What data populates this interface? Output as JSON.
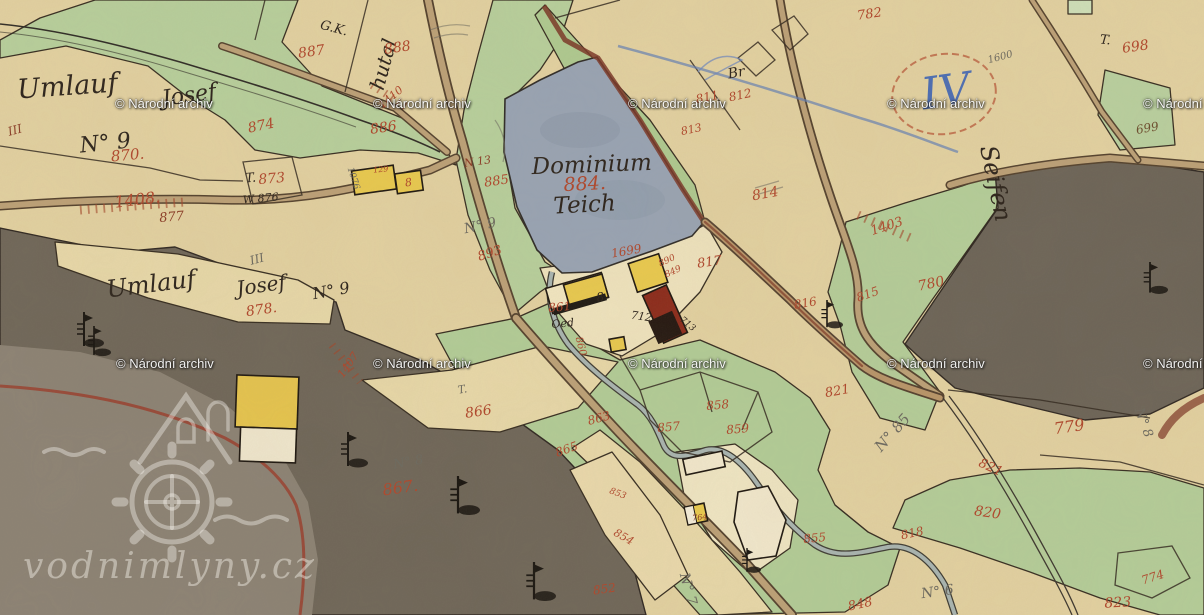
{
  "watermark": {
    "label": "© Národní archiv",
    "rows": [
      {
        "top": 96,
        "xs": [
          115,
          373,
          628,
          887,
          1143
        ]
      },
      {
        "top": 356,
        "xs": [
          116,
          373,
          628,
          887,
          1143
        ]
      }
    ]
  },
  "logo": {
    "text": "vodnimlyny.cz"
  },
  "colors": {
    "ink": "#2b221a",
    "red": "#b0452a",
    "darkred": "#8a3a24",
    "gray": "#6b685e",
    "blue": "#4a6cb3",
    "brown": "#6a4a2a"
  },
  "map": {
    "labels": [
      {
        "t": "Umlauf",
        "x": 68,
        "y": 95,
        "s": 27,
        "c": "ink",
        "r": -4
      },
      {
        "t": "Josef",
        "x": 190,
        "y": 102,
        "s": 22,
        "c": "ink",
        "r": -8
      },
      {
        "t": "N° 9",
        "x": 106,
        "y": 150,
        "s": 22,
        "c": "ink",
        "r": -6
      },
      {
        "t": "Umlauf",
        "x": 152,
        "y": 292,
        "s": 24,
        "c": "ink",
        "r": -7
      },
      {
        "t": "Josef",
        "x": 262,
        "y": 292,
        "s": 20,
        "c": "ink",
        "r": -8
      },
      {
        "t": "N° 9",
        "x": 332,
        "y": 296,
        "s": 16,
        "c": "ink",
        "r": -10
      },
      {
        "t": "Dominium",
        "x": 592,
        "y": 172,
        "s": 23,
        "c": "ink",
        "r": -2
      },
      {
        "t": "Teich",
        "x": 585,
        "y": 212,
        "s": 23,
        "c": "ink",
        "r": -3
      },
      {
        "t": "884.",
        "x": 585,
        "y": 190,
        "s": 19,
        "c": "red",
        "r": -3
      },
      {
        "t": "Oed",
        "x": 563,
        "y": 327,
        "s": 11,
        "c": "ink",
        "r": -5
      },
      {
        "t": "712",
        "x": 641,
        "y": 320,
        "s": 11,
        "c": "ink",
        "r": 8
      },
      {
        "t": "713",
        "x": 686,
        "y": 326,
        "s": 9,
        "c": "ink",
        "r": 40
      },
      {
        "t": "8",
        "x": 601,
        "y": 301,
        "s": 12,
        "c": "ink",
        "r": -10
      },
      {
        "t": "Seifen",
        "x": 988,
        "y": 185,
        "s": 24,
        "c": "ink",
        "r": 78
      },
      {
        "t": "G.K.",
        "x": 333,
        "y": 32,
        "s": 13,
        "c": "ink",
        "r": 15
      },
      {
        "t": "Br",
        "x": 737,
        "y": 77,
        "s": 14,
        "c": "ink",
        "r": -10
      },
      {
        "t": "T.",
        "x": 251,
        "y": 182,
        "s": 13,
        "c": "ink",
        "r": -5
      },
      {
        "t": "T.",
        "x": 1105,
        "y": 44,
        "s": 13,
        "c": "ink",
        "r": 5
      },
      {
        "t": "T.",
        "x": 463,
        "y": 393,
        "s": 11,
        "c": "gray",
        "r": -10
      },
      {
        "t": "W 876",
        "x": 261,
        "y": 202,
        "s": 11,
        "c": "ink",
        "r": -5
      },
      {
        "t": "hutal",
        "x": 390,
        "y": 66,
        "s": 20,
        "c": "ink",
        "r": -75
      },
      {
        "t": "N° 9",
        "x": 481,
        "y": 230,
        "s": 14,
        "c": "gray",
        "r": -12
      },
      {
        "t": "N° 85",
        "x": 896,
        "y": 436,
        "s": 15,
        "c": "gray",
        "r": -48
      },
      {
        "t": "N° 6",
        "x": 938,
        "y": 596,
        "s": 14,
        "c": "gray",
        "r": -8
      },
      {
        "t": "N° 7",
        "x": 684,
        "y": 590,
        "s": 14,
        "c": "gray",
        "r": 75
      },
      {
        "t": "N° 8",
        "x": 409,
        "y": 466,
        "s": 13,
        "c": "gray",
        "r": -10
      },
      {
        "t": "N° 8",
        "x": 1140,
        "y": 424,
        "s": 13,
        "c": "gray",
        "r": 70
      },
      {
        "t": "III",
        "x": 258,
        "y": 263,
        "s": 12,
        "c": "gray",
        "r": -15
      },
      {
        "t": "III",
        "x": 16,
        "y": 134,
        "s": 12,
        "c": "darkred",
        "r": -15
      },
      {
        "t": "1076",
        "x": 351,
        "y": 179,
        "s": 9,
        "c": "gray",
        "r": 72
      },
      {
        "t": "1600",
        "x": 1001,
        "y": 60,
        "s": 10,
        "c": "gray",
        "r": -15
      },
      {
        "t": "IV",
        "x": 948,
        "y": 106,
        "s": 44,
        "c": "blue",
        "r": -8
      },
      {
        "t": "870.",
        "x": 128,
        "y": 160,
        "s": 15,
        "c": "red",
        "r": -5
      },
      {
        "t": "874",
        "x": 262,
        "y": 130,
        "s": 14,
        "c": "red",
        "r": -12
      },
      {
        "t": "877",
        "x": 172,
        "y": 221,
        "s": 13,
        "c": "darkred",
        "r": -5
      },
      {
        "t": "1408.",
        "x": 138,
        "y": 205,
        "s": 16,
        "c": "red",
        "r": -7
      },
      {
        "t": "873",
        "x": 272,
        "y": 183,
        "s": 14,
        "c": "red",
        "r": -5
      },
      {
        "t": "878.",
        "x": 262,
        "y": 314,
        "s": 14,
        "c": "red",
        "r": -8
      },
      {
        "t": "887",
        "x": 312,
        "y": 56,
        "s": 14,
        "c": "red",
        "r": -8
      },
      {
        "t": "888",
        "x": 398,
        "y": 52,
        "s": 14,
        "c": "red",
        "r": -8
      },
      {
        "t": "886",
        "x": 384,
        "y": 132,
        "s": 14,
        "c": "red",
        "r": -8
      },
      {
        "t": "885",
        "x": 497,
        "y": 185,
        "s": 13,
        "c": "red",
        "r": -8
      },
      {
        "t": "N 13",
        "x": 478,
        "y": 165,
        "s": 11,
        "c": "darkred",
        "r": -8
      },
      {
        "t": "893",
        "x": 491,
        "y": 257,
        "s": 13,
        "c": "red",
        "r": -18
      },
      {
        "t": "129",
        "x": 381,
        "y": 172,
        "s": 8,
        "c": "red",
        "r": -5
      },
      {
        "t": "782",
        "x": 870,
        "y": 18,
        "s": 13,
        "c": "red",
        "r": -8
      },
      {
        "t": "811",
        "x": 708,
        "y": 101,
        "s": 12,
        "c": "red",
        "r": -12
      },
      {
        "t": "812",
        "x": 741,
        "y": 99,
        "s": 12,
        "c": "red",
        "r": -12
      },
      {
        "t": "813",
        "x": 692,
        "y": 133,
        "s": 11,
        "c": "red",
        "r": -12
      },
      {
        "t": "814",
        "x": 766,
        "y": 198,
        "s": 14,
        "c": "red",
        "r": -10
      },
      {
        "t": "817",
        "x": 710,
        "y": 266,
        "s": 13,
        "c": "red",
        "r": -8
      },
      {
        "t": "816",
        "x": 806,
        "y": 307,
        "s": 12,
        "c": "red",
        "r": -10
      },
      {
        "t": "815",
        "x": 869,
        "y": 298,
        "s": 12,
        "c": "red",
        "r": -20
      },
      {
        "t": "780",
        "x": 932,
        "y": 288,
        "s": 14,
        "c": "red",
        "r": -12
      },
      {
        "t": "1403",
        "x": 888,
        "y": 230,
        "s": 13,
        "c": "red",
        "r": -18
      },
      {
        "t": "698",
        "x": 1136,
        "y": 51,
        "s": 14,
        "c": "red",
        "r": -8
      },
      {
        "t": "699",
        "x": 1148,
        "y": 132,
        "s": 12,
        "c": "brown",
        "r": -10
      },
      {
        "t": "779",
        "x": 1070,
        "y": 432,
        "s": 16,
        "c": "red",
        "r": -8
      },
      {
        "t": "821",
        "x": 838,
        "y": 395,
        "s": 13,
        "c": "red",
        "r": -10
      },
      {
        "t": "821",
        "x": 989,
        "y": 471,
        "s": 13,
        "c": "red",
        "r": 25
      },
      {
        "t": "820",
        "x": 987,
        "y": 517,
        "s": 14,
        "c": "red",
        "r": 8
      },
      {
        "t": "818",
        "x": 913,
        "y": 537,
        "s": 12,
        "c": "red",
        "r": -12
      },
      {
        "t": "848",
        "x": 861,
        "y": 608,
        "s": 13,
        "c": "red",
        "r": -12
      },
      {
        "t": "823",
        "x": 1118,
        "y": 607,
        "s": 14,
        "c": "red",
        "r": -3
      },
      {
        "t": "774",
        "x": 1154,
        "y": 581,
        "s": 12,
        "c": "red",
        "r": -18
      },
      {
        "t": "866",
        "x": 479,
        "y": 416,
        "s": 14,
        "c": "red",
        "r": -8
      },
      {
        "t": "867.",
        "x": 401,
        "y": 493,
        "s": 16,
        "c": "red",
        "r": -8
      },
      {
        "t": "863",
        "x": 600,
        "y": 422,
        "s": 12,
        "c": "red",
        "r": -15
      },
      {
        "t": "865",
        "x": 568,
        "y": 453,
        "s": 12,
        "c": "red",
        "r": -20
      },
      {
        "t": "857",
        "x": 669,
        "y": 431,
        "s": 12,
        "c": "red",
        "r": -5
      },
      {
        "t": "858",
        "x": 718,
        "y": 409,
        "s": 12,
        "c": "red",
        "r": -5
      },
      {
        "t": "859",
        "x": 738,
        "y": 433,
        "s": 12,
        "c": "red",
        "r": -5
      },
      {
        "t": "855",
        "x": 815,
        "y": 542,
        "s": 12,
        "c": "red",
        "r": -5
      },
      {
        "t": "854",
        "x": 622,
        "y": 540,
        "s": 11,
        "c": "red",
        "r": 30
      },
      {
        "t": "853",
        "x": 617,
        "y": 496,
        "s": 9,
        "c": "red",
        "r": 20
      },
      {
        "t": "852",
        "x": 605,
        "y": 593,
        "s": 12,
        "c": "red",
        "r": -8
      },
      {
        "t": "861",
        "x": 560,
        "y": 311,
        "s": 12,
        "c": "red",
        "r": -5
      },
      {
        "t": "860",
        "x": 578,
        "y": 347,
        "s": 10,
        "c": "red",
        "r": 75
      },
      {
        "t": "1699",
        "x": 627,
        "y": 255,
        "s": 12,
        "c": "red",
        "r": -10
      },
      {
        "t": "890",
        "x": 668,
        "y": 263,
        "s": 9,
        "c": "red",
        "r": -25
      },
      {
        "t": "849",
        "x": 674,
        "y": 274,
        "s": 9,
        "c": "red",
        "r": -25
      },
      {
        "t": "1407",
        "x": 351,
        "y": 367,
        "s": 11,
        "c": "red",
        "r": -55
      },
      {
        "t": "1410",
        "x": 393,
        "y": 100,
        "s": 11,
        "c": "red",
        "r": -40
      },
      {
        "t": "764",
        "x": 700,
        "y": 520,
        "s": 8,
        "c": "darkred",
        "r": -5
      },
      {
        "t": "8",
        "x": 409,
        "y": 186,
        "s": 11,
        "c": "red",
        "r": -8
      }
    ]
  }
}
